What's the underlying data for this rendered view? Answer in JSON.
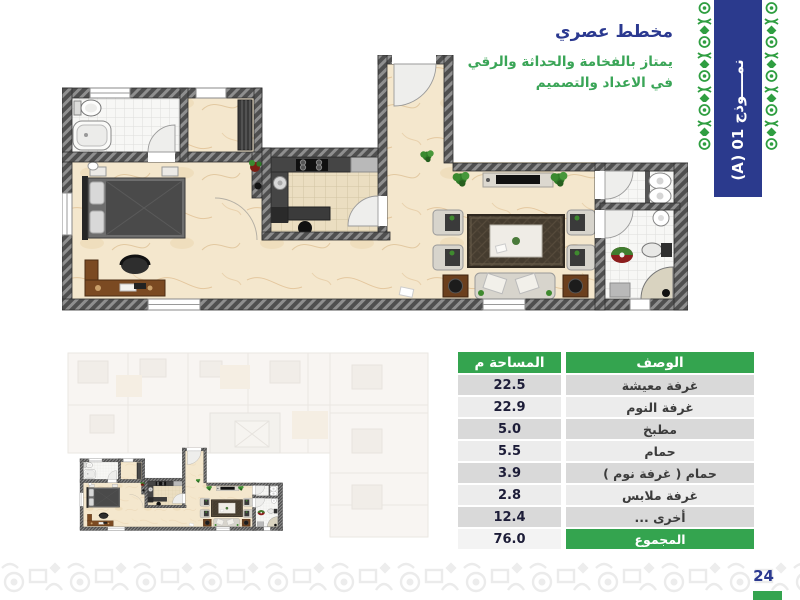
{
  "header": {
    "title": "مخطط عصري",
    "subtitle_line1": "يمتاز بالفخامة والحداثة والرقي",
    "subtitle_line2": "في الاعداد والتصميم",
    "title_color": "#2b3990",
    "subtitle_color": "#3aa557"
  },
  "banner": {
    "label": "نمــــوذج 01 (A)",
    "bg_color": "#2b3a8d",
    "ornament_color": "#2f9e41"
  },
  "table": {
    "headers": {
      "description": "الوصف",
      "area": "المساحة م"
    },
    "rows": [
      {
        "label": "غرفة معيشة",
        "area": "22.5"
      },
      {
        "label": "غرفة النوم",
        "area": "22.9"
      },
      {
        "label": "مطبخ",
        "area": "5.0"
      },
      {
        "label": "حمام",
        "area": "5.5"
      },
      {
        "label": "حمام ( غرفة نوم )",
        "area": "3.9"
      },
      {
        "label": "غرفة ملابس",
        "area": "2.8"
      },
      {
        "label": "أخرى ...",
        "area": "12.4"
      }
    ],
    "total": {
      "label": "المجموع",
      "area": "76.0"
    },
    "header_bg": "#34a44f",
    "row_colors": [
      "#d9d9d9",
      "#ececec"
    ]
  },
  "page": {
    "number": "24",
    "accent_green": "#34a44f",
    "accent_navy": "#2b3990"
  },
  "floorplan": {
    "wall_color": "#4f4f4f",
    "floor_marble": "#f4e7cd",
    "carpet_color": "#453c2f",
    "plant_color": "#2f7a27"
  }
}
